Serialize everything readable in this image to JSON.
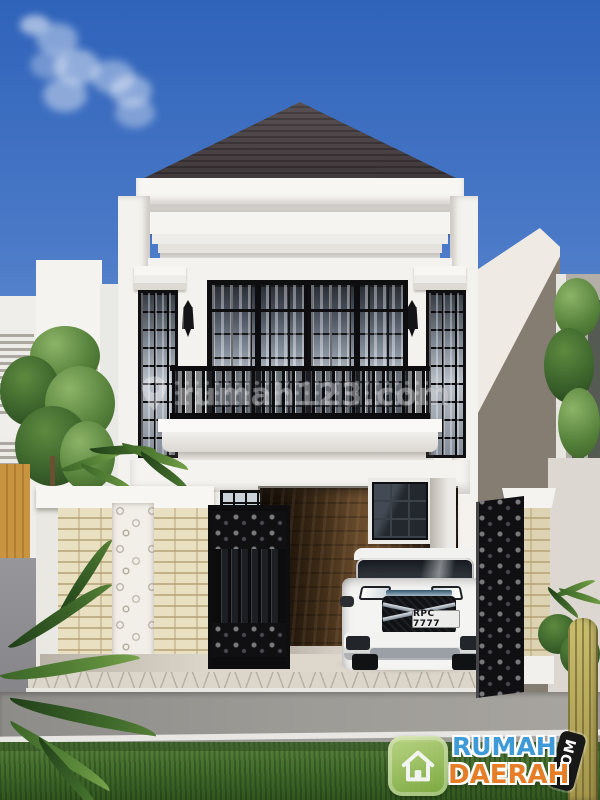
{
  "watermark": {
    "icon": "location-pin-icon",
    "text": "rumah123.com"
  },
  "vehicle": {
    "license_plate": "RPC 7777"
  },
  "logo": {
    "icon": "house-icon",
    "title_top": "RUMAH",
    "title_bottom": "DAERAH",
    "domain_tag": ".COM",
    "colors": {
      "title_top": "#3f9bd7",
      "title_bottom": "#e67d27",
      "icon_bg": "#8db84e",
      "tag_bg": "#181818"
    }
  },
  "palette": {
    "sky_top": "#2f63ba",
    "sky_bottom": "#92b4de",
    "roof": "#443c3e",
    "walls": "#f4f2ee",
    "fence_brick": "#e9dfc1",
    "wood_wall": "#65482a",
    "ironwork": "#0e0e10",
    "road": "#94928e",
    "grass": "#46702f",
    "car_body": "#f2f2f0"
  }
}
